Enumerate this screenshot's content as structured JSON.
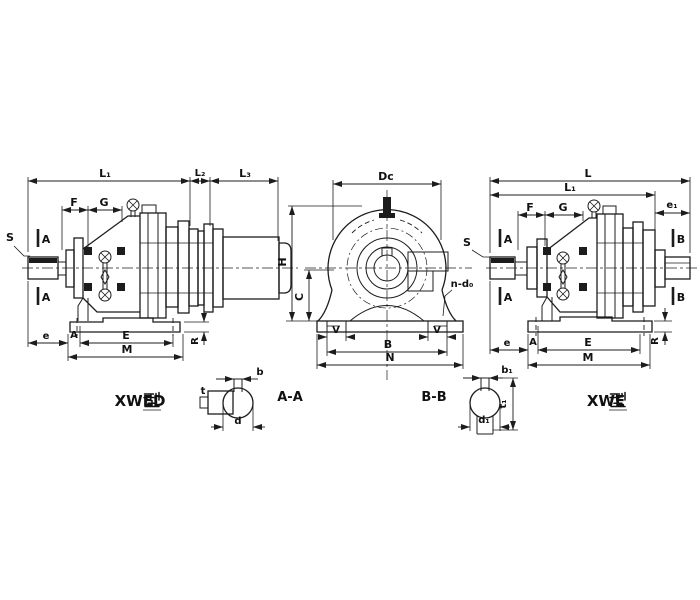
{
  "drawing": {
    "background": "#ffffff",
    "ink_color": "#1c1c1c",
    "captions": {
      "xwed_model": "XWED",
      "xwed_suffix": "型",
      "xwed_full": "XWED 型",
      "xwe_model": "XWE",
      "xwe_suffix": "型",
      "xwe_full": "XWE 型",
      "section_aa": "A-A",
      "section_bb": "B-B"
    },
    "xwed_view": {
      "dim_l1": "L₁",
      "dim_l2": "L₂",
      "dim_l3": "L₃",
      "dim_f": "F",
      "dim_g": "G",
      "shaft_callout": "S",
      "cut_mark": "A",
      "dim_e": "e",
      "dim_a": "A",
      "dim_e_big": "E",
      "dim_m": "M",
      "dim_r": "R"
    },
    "end_view": {
      "dim_dc": "Dc",
      "dim_h": "H",
      "dim_c": "C",
      "dim_v": "V",
      "dim_b": "B",
      "dim_n": "N",
      "holes_callout": "n-d₀"
    },
    "xwe_view": {
      "dim_l": "L",
      "dim_l1": "L₁",
      "dim_f": "F",
      "dim_g": "G",
      "dim_e1": "e₁",
      "shaft_callout": "S",
      "cut_mark_a": "A",
      "cut_mark_b": "B",
      "dim_e": "e",
      "dim_a": "A",
      "dim_e_big": "E",
      "dim_m": "M",
      "dim_r": "R"
    },
    "section_aa": {
      "dim_b": "b",
      "dim_t": "t",
      "dim_d": "d"
    },
    "section_bb": {
      "dim_b1": "b₁",
      "dim_t1": "t₁",
      "dim_d1": "d₁"
    }
  }
}
